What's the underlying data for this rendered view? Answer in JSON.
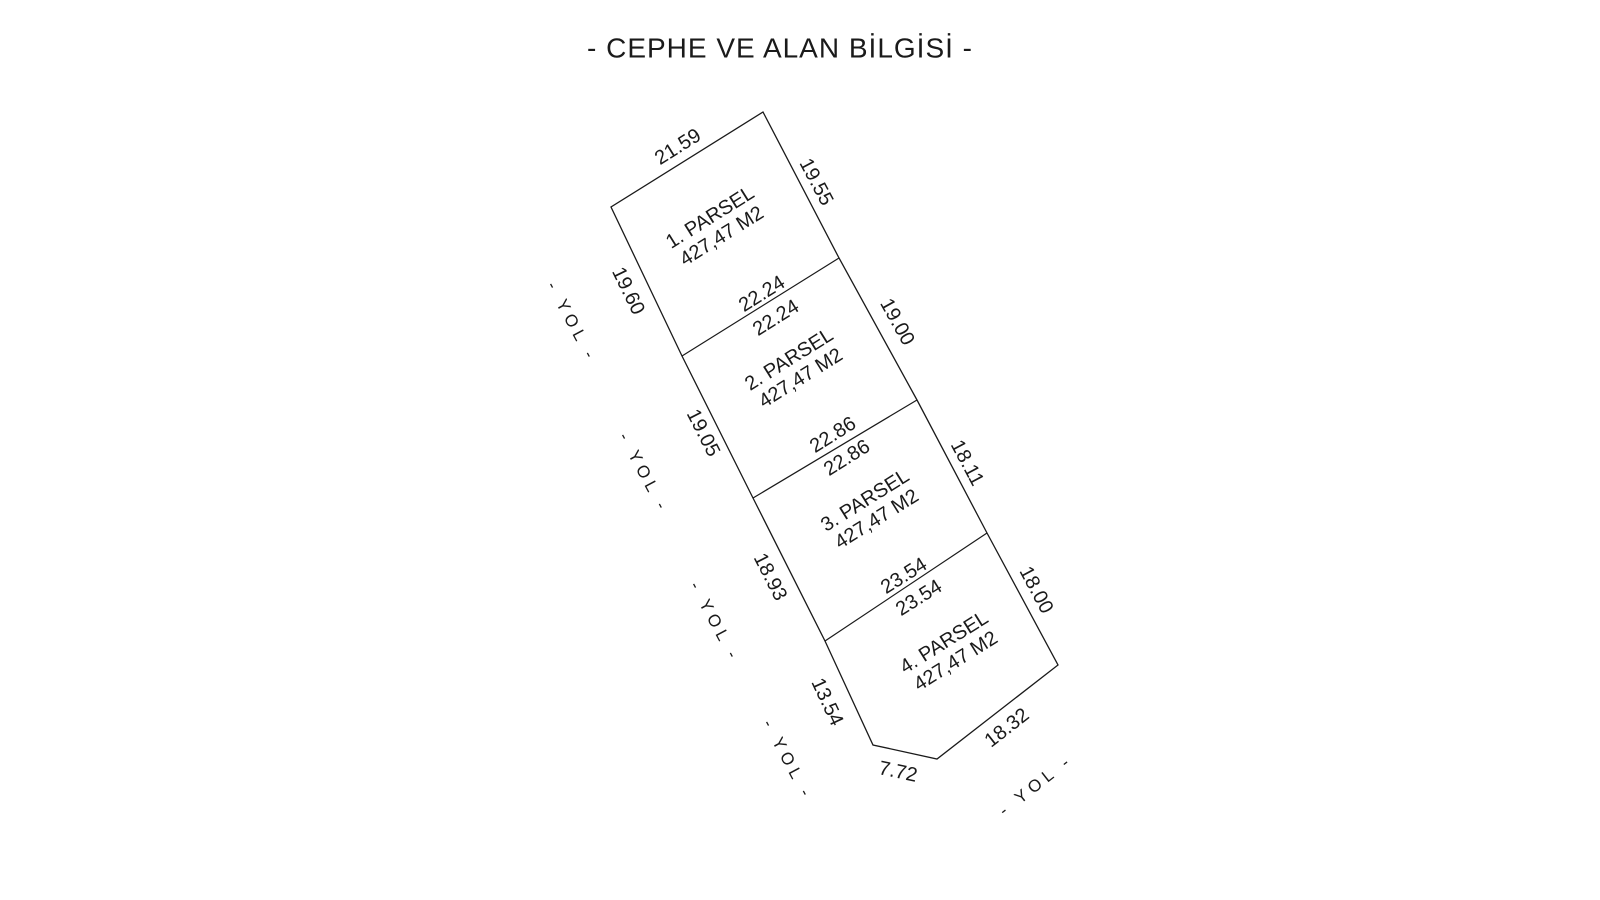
{
  "title": "- CEPHE VE ALAN BİLGİSİ -",
  "parcels": [
    {
      "name": "1. PARSEL",
      "area": "427,47 M2"
    },
    {
      "name": "2. PARSEL",
      "area": "427,47 M2"
    },
    {
      "name": "3. PARSEL",
      "area": "427,47 M2"
    },
    {
      "name": "4. PARSEL",
      "area": "427,47 M2"
    }
  ],
  "edges": {
    "top": "21.59",
    "right1": "19.55",
    "right2": "19.00",
    "right3": "18.11",
    "right4": "18.00",
    "bottom_right": "18.32",
    "bottom": "7.72",
    "left4": "13.54",
    "left3": "18.93",
    "left2": "19.05",
    "left1": "19.60"
  },
  "dividers": {
    "d12_upper": "22.24",
    "d12_lower": "22.24",
    "d23_upper": "22.86",
    "d23_lower": "22.86",
    "d34_upper": "23.54",
    "d34_lower": "23.54"
  },
  "road_labels": [
    "- YOL -",
    "- YOL -",
    "- YOL -",
    "- YOL -",
    "- YOL -"
  ],
  "colors": {
    "line": "#1a1a1a",
    "text": "#1a1a1a",
    "background": "#ffffff"
  }
}
